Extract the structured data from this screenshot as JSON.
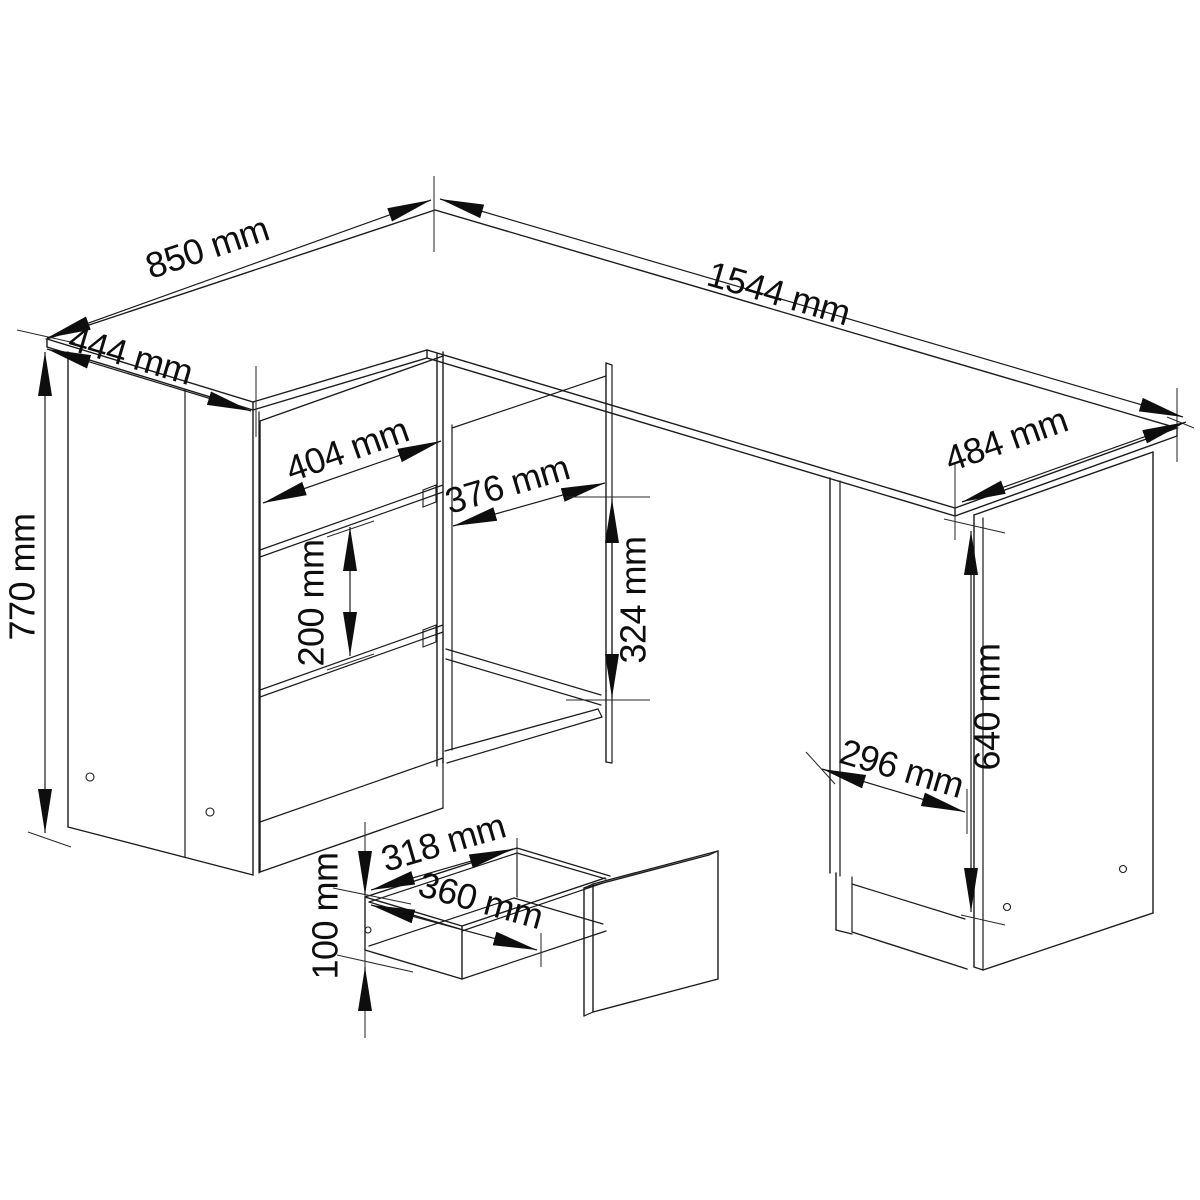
{
  "drawing": {
    "unit": "mm",
    "colors": {
      "line": "#1b1b1b",
      "background": "#ffffff"
    },
    "dims": {
      "d850": {
        "label": "850 mm",
        "value_mm": 850
      },
      "d444": {
        "label": "444 mm",
        "value_mm": 444
      },
      "d1544": {
        "label": "1544 mm",
        "value_mm": 1544
      },
      "d484": {
        "label": "484 mm",
        "value_mm": 484
      },
      "d770": {
        "label": "770 mm",
        "value_mm": 770
      },
      "d404": {
        "label": "404 mm",
        "value_mm": 404
      },
      "d200": {
        "label": "200 mm",
        "value_mm": 200
      },
      "d376": {
        "label": "376 mm",
        "value_mm": 376
      },
      "d324": {
        "label": "324 mm",
        "value_mm": 324
      },
      "d640": {
        "label": "640 mm",
        "value_mm": 640
      },
      "d296": {
        "label": "296 mm",
        "value_mm": 296
      },
      "d318": {
        "label": "318 mm",
        "value_mm": 318
      },
      "d360": {
        "label": "360 mm",
        "value_mm": 360
      },
      "d100": {
        "label": "100 mm",
        "value_mm": 100
      }
    }
  }
}
